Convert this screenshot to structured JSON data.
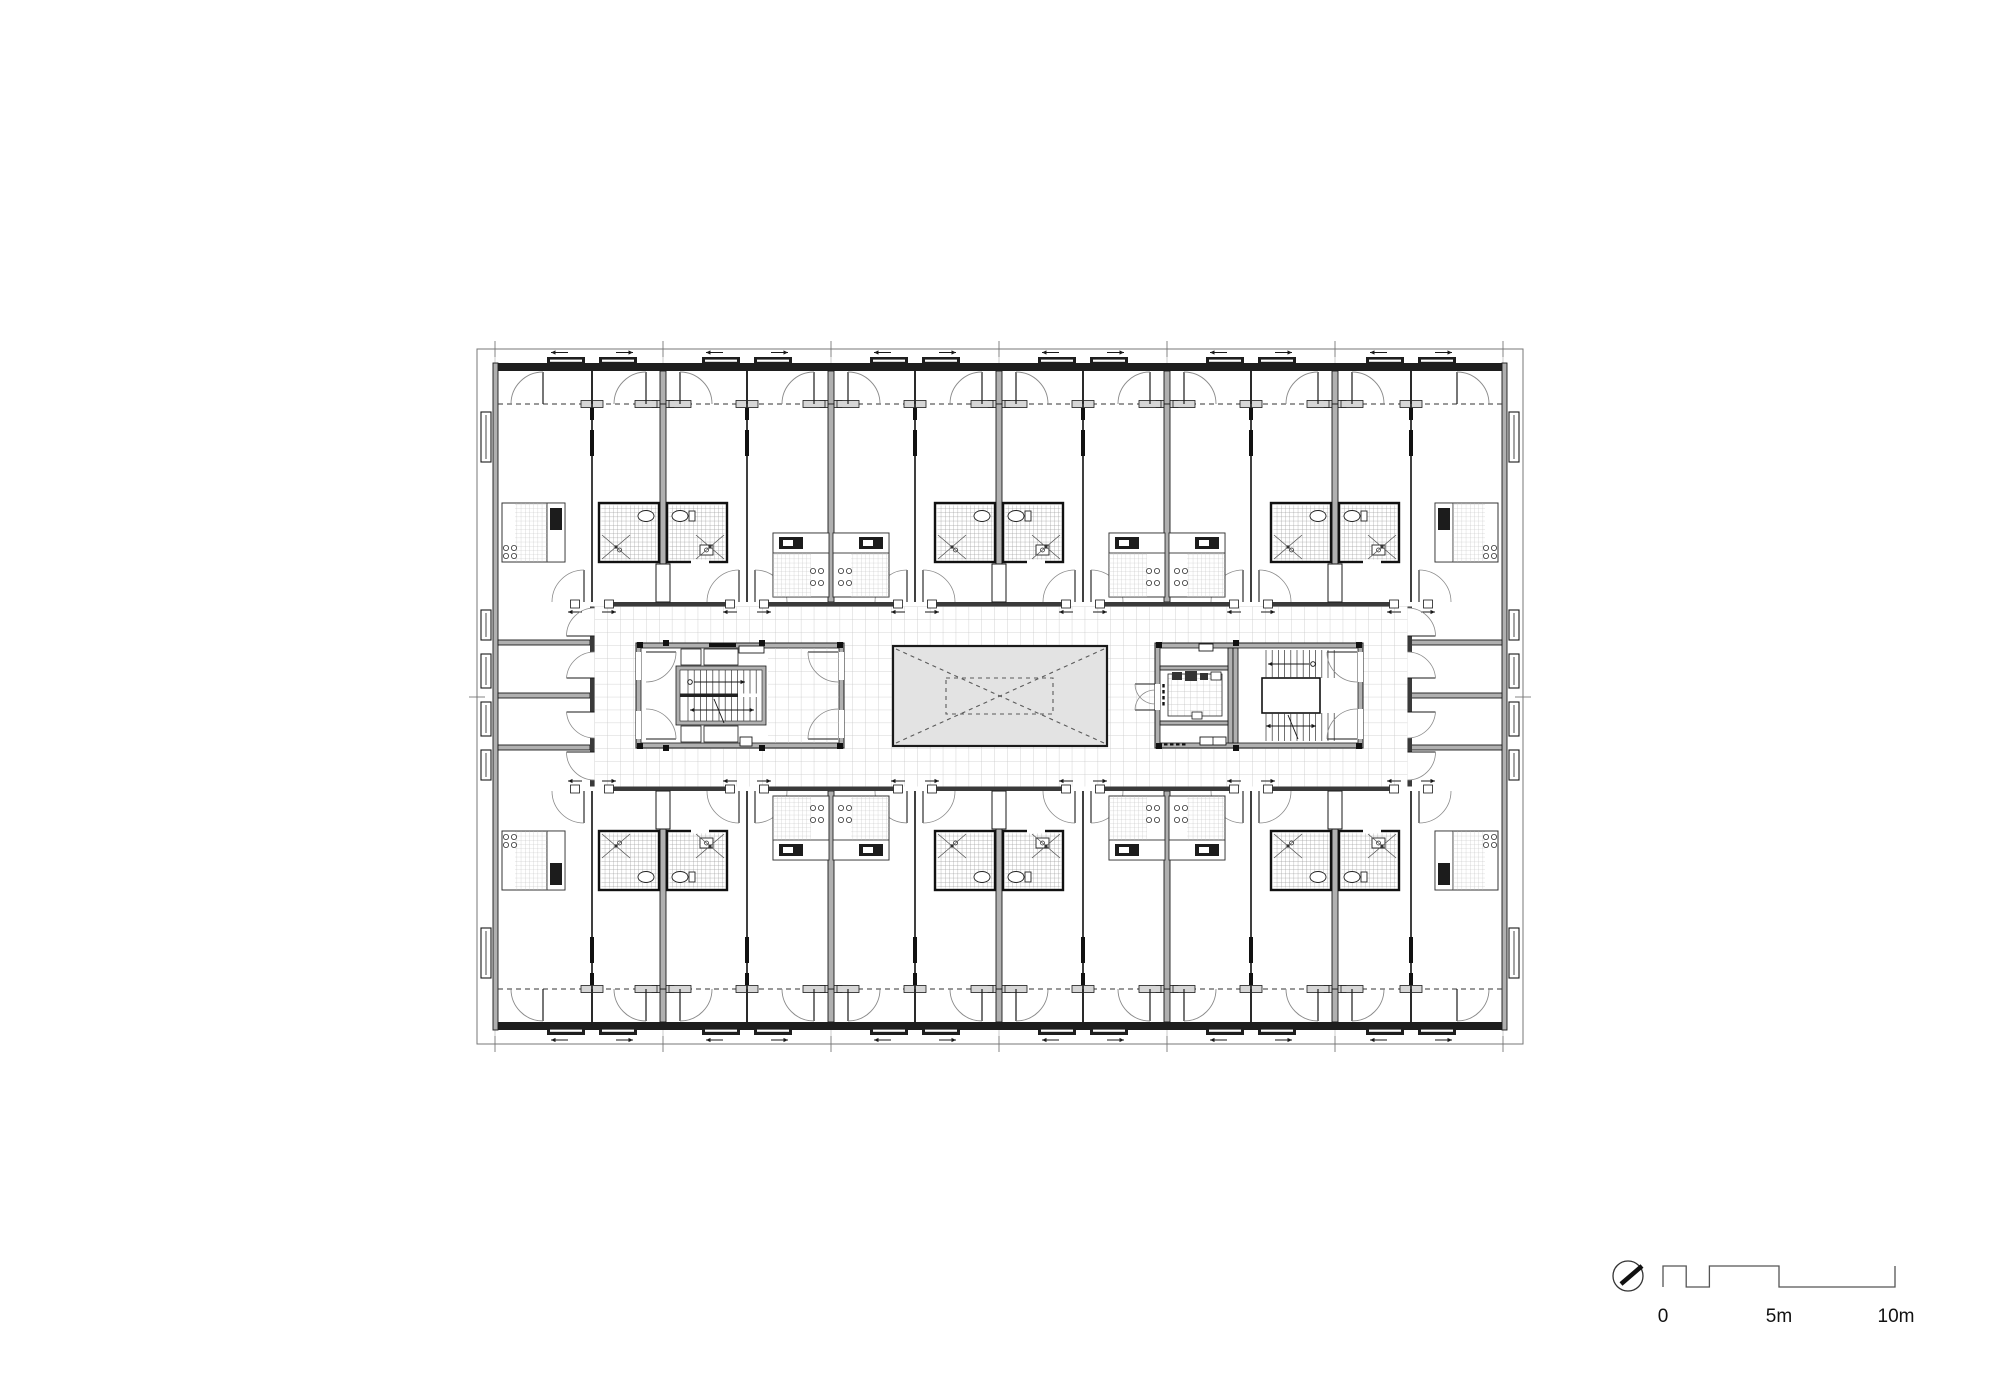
{
  "title": "residential-tower-typical-floor-plan",
  "colors": {
    "ink": "#1a1a1a",
    "wall_dark": "#1e1e1e",
    "wall_gray_fill": "#b0b0b0",
    "corridor_wall": "#3a3a3a",
    "thin_wall": "#2a2a2a",
    "grid_corridor": "#c9c9c9",
    "grid_tile": "#bcbcbc",
    "grid_pod": "#a0a0a0",
    "grid_lobby": "#c2c2c2",
    "void_fill": "#e3e3e3",
    "void_dash": "#5a5a5a",
    "arc": "#8a8a8a",
    "boundary": "#777777",
    "sill_fill": "#d6d6d6",
    "fixture": "#222222",
    "appliance_dark": "#1c1c1c"
  },
  "plan": {
    "outer": [
      477,
      349,
      1523,
      1044
    ],
    "building": [
      493,
      363,
      1507,
      1030
    ],
    "facade_thickness": 8,
    "glazing_top_y": 404,
    "glazing_bottom_y": 989,
    "loggia_top": [
      371,
      404
    ],
    "loggia_bottom": [
      989,
      1022
    ],
    "module_xs": [
      495,
      663,
      831,
      999,
      1167,
      1335,
      1503
    ],
    "side_tick_y": 697,
    "unit_bounds": [
      592,
      663,
      747,
      831,
      915,
      999,
      1083,
      1167,
      1251,
      1335,
      1411
    ],
    "anchors": [
      663,
      663,
      831,
      831,
      999,
      999,
      1167,
      1167,
      1335,
      1335
    ],
    "services": [
      "bath",
      "bath",
      "kitchen",
      "kitchen",
      "bath",
      "bath",
      "kitchen",
      "kitchen",
      "bath",
      "bath"
    ],
    "pod_pair_anchors": [
      663,
      999,
      1335
    ],
    "thin_entry_walls": [
      592,
      747,
      915,
      1083,
      1251,
      1411
    ],
    "window_pair_xs": [
      592,
      747,
      915,
      1083,
      1251,
      1411
    ],
    "corridor": [
      590,
      602,
      1412,
      791
    ],
    "corridor_wall_t": 4.5,
    "top_row": {
      "pod_y": [
        503,
        562
      ],
      "kitchen_y": [
        533,
        597
      ],
      "vestibule_y": [
        562,
        602
      ]
    },
    "mirror_axis_y": 696.5,
    "left_core": [
      636,
      643,
      844,
      748
    ],
    "right_core": [
      1155,
      643,
      1363,
      748
    ],
    "void_rect": [
      893,
      646,
      1107,
      746
    ],
    "void_inner": [
      946,
      678,
      1053,
      714
    ],
    "end_wall_ys": [
      640,
      693,
      745
    ],
    "end_zone_left_x": [
      498,
      590
    ],
    "end_zone_right_x": [
      1410,
      1502
    ],
    "end_window_ys": [
      [
        412,
        462
      ],
      [
        610,
        640
      ],
      [
        654,
        688
      ],
      [
        702,
        736
      ],
      [
        750,
        780
      ],
      [
        928,
        978
      ]
    ],
    "corner_door_hinges": [
      543,
      1457
    ],
    "loggia_door_radius": 32,
    "grid_cell_corridor": 12.9,
    "grid_cell_tile": 4.2,
    "grid_cell_lobby": 6.4
  },
  "scale_bar": {
    "labels": [
      "0",
      "5m",
      "10m"
    ],
    "x_zero": 1663,
    "x_ten": 1895,
    "y_top": 1266,
    "y_bottom": 1287,
    "label_y": 1322,
    "label_xs": [
      1663,
      1779,
      1896
    ],
    "break_meters": [
      0,
      1,
      2,
      5,
      10
    ],
    "polyline_meters": [
      [
        0,
        "b"
      ],
      [
        0,
        "t"
      ],
      [
        1,
        "t"
      ],
      [
        1,
        "b"
      ],
      [
        2,
        "b"
      ],
      [
        2,
        "t"
      ],
      [
        5,
        "t"
      ],
      [
        5,
        "b"
      ],
      [
        10,
        "b"
      ],
      [
        10,
        "t"
      ]
    ]
  },
  "north_indicator": {
    "cx": 1628,
    "cy": 1276,
    "r": 15,
    "needle": [
      1621,
      1284,
      1642,
      1266
    ]
  }
}
